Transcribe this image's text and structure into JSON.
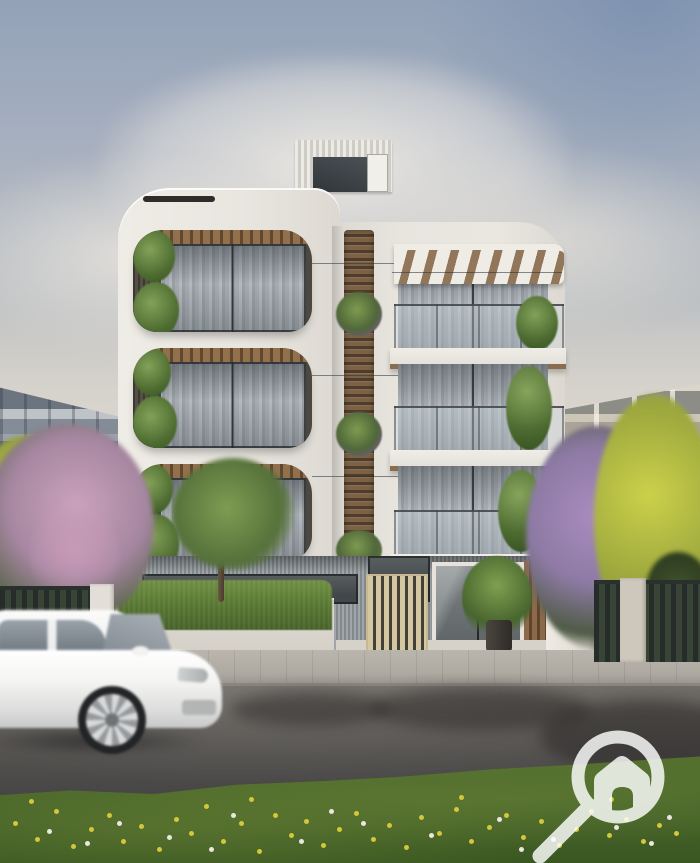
{
  "scene": {
    "type": "architectural-exterior-render",
    "description": "Street-level render of a modern four-storey white apartment building with three balcony levels, a central wood louver screen, rooftop stair bulkhead, front hedge and fences, neighbouring apartment blocks, blossoming trees, a motion-blurred white SUV passing on the road, and a wildflower grass verge in the foreground.",
    "building": {
      "number": "146",
      "floors_visible": 4,
      "balcony_levels": 3
    },
    "vehicle": {
      "type": "white SUV",
      "motion": "blurred, driving right"
    },
    "watermark": {
      "icon": "magnifier-house-icon"
    },
    "palette": {
      "sky_top": "#96a5ba",
      "sky_haze": "#d8d4ce",
      "building_white": "#e9e6e0",
      "cladding_grey": "#868d91",
      "wood": "#7a5f44",
      "glass": "#98a0a8",
      "fence_dark": "#2f3536",
      "road": "#55534f",
      "sidewalk": "#b3afa7",
      "grass": "#49662a",
      "dandelion": "#d4c73c",
      "blossom_pink": "#c59ab5",
      "blossom_purple": "#9c87b4",
      "tree_yellow": "#b8b545",
      "hedge_green": "#5d7a3a",
      "car_white": "#f4f4f3"
    }
  }
}
